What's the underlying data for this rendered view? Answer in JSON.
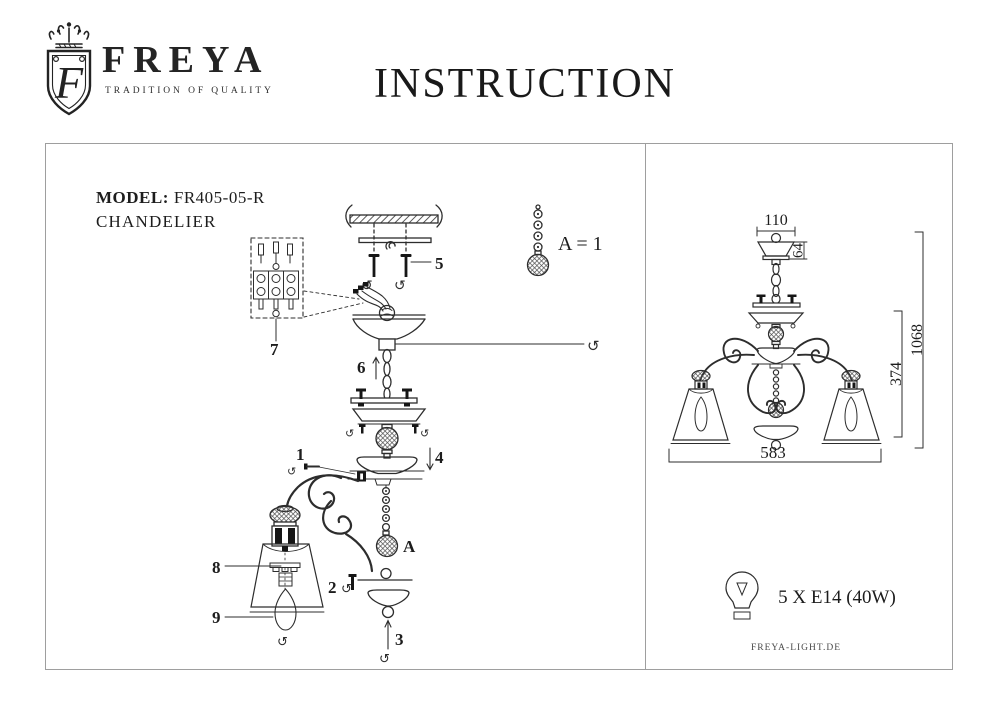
{
  "header": {
    "brand": "FREYA",
    "tagline": "TRADITION OF QUALITY",
    "monogram": "F",
    "title": "INSTRUCTION"
  },
  "left_panel": {
    "model_label": "MODEL:",
    "model_value": "FR405-05-R",
    "product_type": "CHANDELIER",
    "parts": {
      "n1": "1",
      "n2": "2",
      "n3": "3",
      "n4": "4",
      "n5": "5",
      "n6": "6",
      "n7": "7",
      "n8": "8",
      "n9": "9",
      "a": "A"
    },
    "legend": "A = 1"
  },
  "right_panel": {
    "dims": {
      "canopy_width": "110",
      "canopy_height": "64",
      "body_height": "374",
      "total_height": "1068",
      "fixture_width": "583"
    },
    "bulb_spec": "5 X E14 (40W)",
    "website": "FREYA-LIGHT.DE"
  },
  "icons": {
    "rotate": "↺"
  },
  "colors": {
    "ink": "#2d2d2d",
    "border": "#9e9e9e"
  }
}
